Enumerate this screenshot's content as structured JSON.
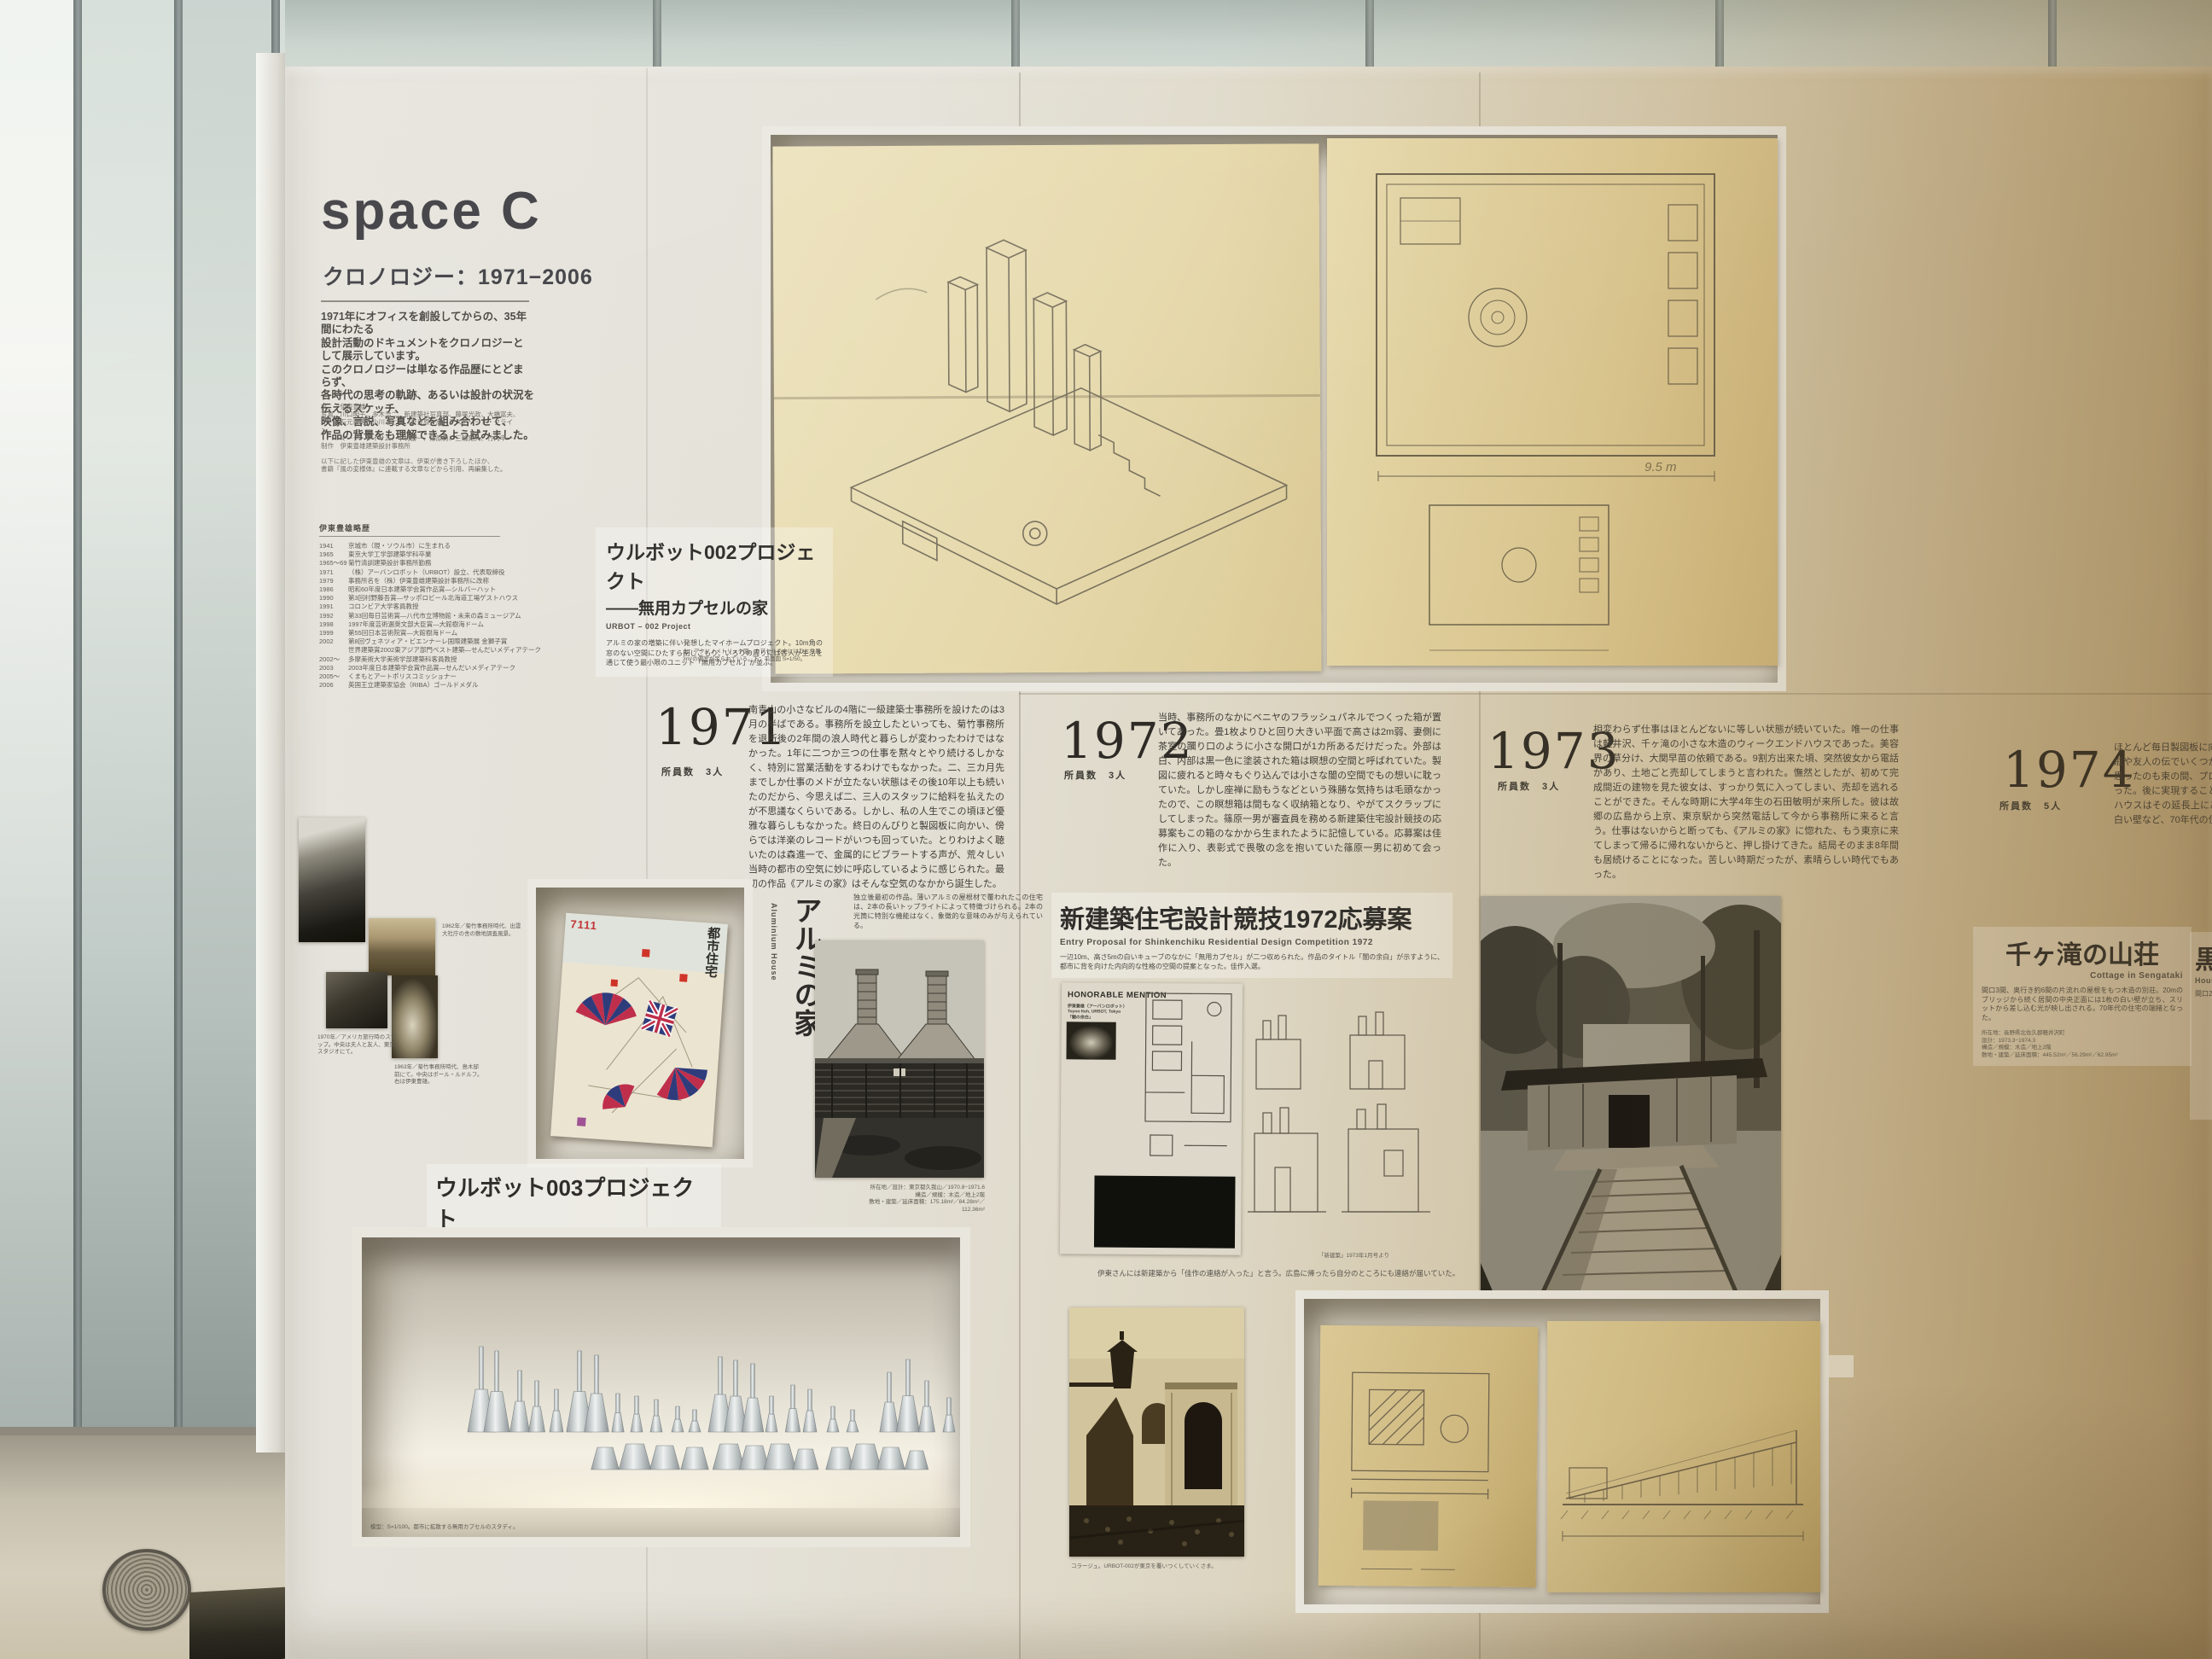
{
  "panel": {
    "title": "space C",
    "subtitle": "クロノロジー：1971−2006"
  },
  "intro": {
    "text": "1971年にオフィスを創設してからの、35年間にわたる\n設計活動のドキュメントをクロノロジーとして展示しています。\nこのクロノロジーは単なる作品歴にとどまらず、\n各時代の思考の軌跡、あるいは設計の状況を伝えるスケッチ、\n映像、言説、写真などを組み合わせて、\n作品の背景をも理解できるよう試みました。"
  },
  "credits": {
    "l1": "文　　伊東豊雄",
    "l2": "写真　川口明子、多木浩二、新建築社写真部、藤塚光政、大橋富夫、",
    "l3": "　　　石元泰博、小川さとし、奈良原一高、アストリッド・クライン、",
    "l4": "　　　マーク・ダイサム、中村勝一、篠原勇、三輪晃久、竹内申一",
    "l5": "制作　伊東豊雄建築設計事務所",
    "note1": "以下に記した伊東豊雄の文章は、伊東が書き下ろしたほか、",
    "note2": "書籍『風の変様体』に連載する文章などから引用、再編集した。"
  },
  "bio": {
    "heading": "伊東豊雄略歴",
    "rows": [
      {
        "year": "1941",
        "text": "京城市（現・ソウル市）に生まれる"
      },
      {
        "year": "1965",
        "text": "東京大学工学部建築学科卒業"
      },
      {
        "year": "1965〜69",
        "text": "菊竹清訓建築設計事務所勤務"
      },
      {
        "year": "1971",
        "text": "（株）アーバンロボット（URBOT）設立、代表取締役"
      },
      {
        "year": "1979",
        "text": "事務所名を（株）伊東豊雄建築設計事務所に改称"
      },
      {
        "year": "1986",
        "text": "昭和60年度日本建築学会賞作品賞—シルバーハット"
      },
      {
        "year": "1990",
        "text": "第3回村野藤吾賞—サッポロビール北海道工場ゲストハウス"
      },
      {
        "year": "1991",
        "text": "コロンビア大学客員教授"
      },
      {
        "year": "1992",
        "text": "第33回毎日芸術賞—八代市立博物館・未来の森ミュージアム"
      },
      {
        "year": "1998",
        "text": "1997年度芸術選奨文部大臣賞—大館樹海ドーム"
      },
      {
        "year": "1999",
        "text": "第55回日本芸術院賞—大館樹海ドーム"
      },
      {
        "year": "2002",
        "text": "第8回ヴェネツィア・ビエンナーレ国際建築展 金獅子賞"
      },
      {
        "year": "",
        "text": "世界建築賞2002東アジア部門ベスト建築—せんだいメディアテーク"
      },
      {
        "year": "2002〜",
        "text": "多摩美術大学美術学部建築科客員教授"
      },
      {
        "year": "2003",
        "text": "2003年度日本建築学会賞作品賞—せんだいメディアテーク"
      },
      {
        "year": "2005〜",
        "text": "くまもとアートポリスコミッショナー"
      },
      {
        "year": "2006",
        "text": "英国王立建築家協会（RIBA）ゴールドメダル"
      }
    ]
  },
  "urbot002": {
    "title": "ウルボット002プロジェクト",
    "subtitle": "——無用カプセルの家",
    "en": "URBOT – 002 Project",
    "desc": "アルミの家の増築に伴い発想したマイホームプロジェクト。10m角の窓のない空間にひたすら閉じこもり、いろりの周りには各人が生活を通じて使う最小限のユニット「無用カプセル」が並ぶ。",
    "note": "上：アクソノメトリック図。カプセルの中にはひとり用3m²の個室が吊られている。下：平面図 S=1/50。"
  },
  "drawings": {
    "plan_dim": "9.5 m"
  },
  "years": {
    "y1971": {
      "num": "1971",
      "staff_label": "所員数",
      "staff": "3人",
      "text": "南青山の小さなビルの4階に一級建築士事務所を設けたのは3月の半ばである。事務所を設立したといっても、菊竹事務所を退所後の2年間の浪人時代と暮らしが変わったわけではなかった。1年に二つか三つの仕事を黙々とやり続けるしかなく、特別に営業活動をするわけでもなかった。二、三カ月先までしか仕事のメドが立たない状態はその後10年以上も続いたのだから、今思えば二、三人のスタッフに給料を払えたのが不思議なくらいである。しかし、私の人生でこの頃ほど優雅な暮らしもなかった。終日のんびりと製図板に向かい、傍らでは洋楽のレコードがいつも回っていた。とりわけよく聴いたのは森進一で、金属的にビブラートする声が、荒々しい当時の都市の空気に妙に呼応しているように感じられた。最初の作品《アルミの家》はそんな空気のなかから誕生した。"
    },
    "y1972": {
      "num": "1972",
      "staff_label": "所員数",
      "staff": "3人",
      "text": "当時、事務所のなかにベニヤのフラッシュパネルでつくった箱が置いてあった。畳1枚よりひと回り大きい平面で高さは2m弱、妻側に茶室の躙り口のように小さな開口が1カ所あるだけだった。外部は白、内部は黒一色に塗装された箱は瞑想の空間と呼ばれていた。製図に疲れると時々もぐり込んでは小さな闇の空間でもの想いに耽っていた。しかし座禅に励もうなどという殊勝な気持ちは毛頭なかったので、この瞑想箱は間もなく収納箱となり、やがてスクラップにしてしまった。篠原一男が審査員を務める新建築住宅設計競技の応募案もこの箱のなかから生まれたように記憶している。応募案は佳作に入り、表彰式で畏敬の念を抱いていた篠原一男に初めて会った。"
    },
    "y1973": {
      "num": "1973",
      "staff_label": "所員数",
      "staff": "3人",
      "text": "相変わらず仕事はほとんどないに等しい状態が続いていた。唯一の仕事は軽井沢、千ヶ滝の小さな木造のウィークエンドハウスであった。美容界の草分け、大関早苗の依頼である。9割方出来た頃、突然彼女から電話があり、土地ごと売却してしまうと言われた。憮然としたが、初めて完成間近の建物を見た彼女は、すっかり気に入ってしまい、売却を逃れることができた。そんな時期に大学4年生の石田敏明が来所した。彼は故郷の広島から上京、東京駅から突然電話して今から事務所に来ると言う。仕事はないからと断っても、《アルミの家》に惚れた、もう東京に来てしまって帰るに帰れないからと、押し掛けてきた。結局そのまま8年間も居続けることになった。苦しい時期だったが、素晴らしい時代でもあった。"
    },
    "y1974": {
      "num": "1974",
      "staff_label": "所員数",
      "staff": "5人",
      "text": "ほとんど毎日製図板に向かう日々。開いて二、三年もすると、親戚や友人の伝でいくつかの住宅の依頼が入り、給料も払えるかと思ったのも束の間、プロジェクトは一夜の夢に終わることが多かった。後に実現することができた千ヶ滝の小さなウィークエンドハウスはその延長上にある。三角形の断面にそびえて立つ1枚の白い壁など、70年代の住宅の先駆けとなった。"
    }
  },
  "shinkenchiku": {
    "title": "新建築住宅設計競技1972応募案",
    "en": "Entry Proposal for Shinkenchiku Residential Design Competition 1972",
    "desc": "一辺10m、高さ5mの白いキューブのなかに「無用カプセル」が二つ収められた。作品のタイトル「闇の余白」が示すように、都市に背を向けた内向的な性格の空間の提案となった。佳作入選。",
    "honorable": "HONORABLE MENTION",
    "p1": "伊東豊雄（アーバンロボット）",
    "p2": "Toyoo Itoh, URBOT, Tokyo",
    "p3": "「闇の余白」",
    "mag_caption": "「新建築」1973年1月号より"
  },
  "aluminium": {
    "title": "アルミの家",
    "en": "Aluminium House",
    "desc": "独立後最初の作品。薄いアルミの屋根材で覆われたこの住宅は、2本の長いトップライトによって特徴づけられる。2本の光筒に特別な機能はなく、象徴的な意味のみが与えられている。",
    "c1": "所在地／設計：東京都久我山／1970.8−1971.6",
    "c2": "構造／規模：木造／地上2階",
    "c3": "敷地・建築／延床面積：175.18m²／84.28m²／112.36m²"
  },
  "magazine": {
    "masthead": "都市住宅",
    "issue": "7111"
  },
  "photos": {
    "c1": "1962年／菊竹事務所時代、出雲大社庁の舎の敷地調査風景。",
    "c2": "1970年／アメリカ旅行時のスナップ。中央は夫人と友人、東京スタジオにて。",
    "c3": "1963年／菊竹事務所時代、島木邸前にて。中央はポール・ルドルフ。右は伊東豊雄。"
  },
  "urbot003": {
    "title": "ウルボット003プロジェクト",
    "subtitle": "——東京ヴァナキュラリズム",
    "en": "URBOT - 003 Project",
    "desc": "上記プロジェクトのカプセルが独立して、都市に拡散するさまが描かれている。",
    "case_caption": "模型：S=1/100。都市に拡散する無用カプセルのスタディ。"
  },
  "quote": {
    "text": "伊東さんには新建築から「佳作の連絡が入った」と言う。広島に帰ったら自分のところにも連絡が届いていた。"
  },
  "collage": {
    "caption": "コラージュ。URBOT-002が東京を覆いつくしていくさま。"
  },
  "sengataki": {
    "title": "千ヶ滝の山荘",
    "en": "Cottage in Sengataki",
    "desc": "間口3間、奥行き約6間の片流れの屋根をもつ木造の別荘。20mのブリッジから続く居間の中央正面には1枚の白い壁が立ち、スリットから差し込む光が映し出される。70年代の住宅の端緒となった。",
    "d1": "所在地：長野県北佐久郡軽井沢町",
    "d2": "設計：1973.3−1974.3",
    "d3": "構造／規模：木造／地上2階",
    "d4": "敷地・建築／延床面積：445.52m²／56.29m²／62.95m²",
    "photo_caption": "上：ブリッジの先から見た外観。　下：実施図面（矩計図・断面図 S=1/50）"
  },
  "kuro": {
    "title": "黒の回帰",
    "en": "House in …",
    "l1": "間口2間の小さな住宅。中央の黒い空間が特徴。"
  },
  "models": {
    "flasks": [
      [
        140,
        100
      ],
      [
        158,
        95
      ],
      [
        185,
        72
      ],
      [
        205,
        60
      ],
      [
        228,
        50
      ],
      [
        255,
        95
      ],
      [
        275,
        90
      ],
      [
        300,
        45
      ],
      [
        322,
        42
      ],
      [
        345,
        38
      ],
      [
        370,
        30
      ],
      [
        390,
        26
      ],
      [
        420,
        88
      ],
      [
        438,
        84
      ],
      [
        458,
        80
      ],
      [
        480,
        42
      ],
      [
        505,
        55
      ],
      [
        525,
        50
      ],
      [
        552,
        30
      ],
      [
        575,
        26
      ],
      [
        618,
        70
      ],
      [
        640,
        85
      ],
      [
        662,
        60
      ],
      [
        688,
        40
      ]
    ],
    "blocks": [
      [
        285,
        26
      ],
      [
        320,
        30
      ],
      [
        355,
        28
      ],
      [
        390,
        26
      ],
      [
        430,
        30
      ],
      [
        460,
        28
      ],
      [
        490,
        30
      ],
      [
        520,
        24
      ],
      [
        560,
        26
      ],
      [
        590,
        30
      ],
      [
        620,
        26
      ],
      [
        650,
        22
      ]
    ]
  }
}
